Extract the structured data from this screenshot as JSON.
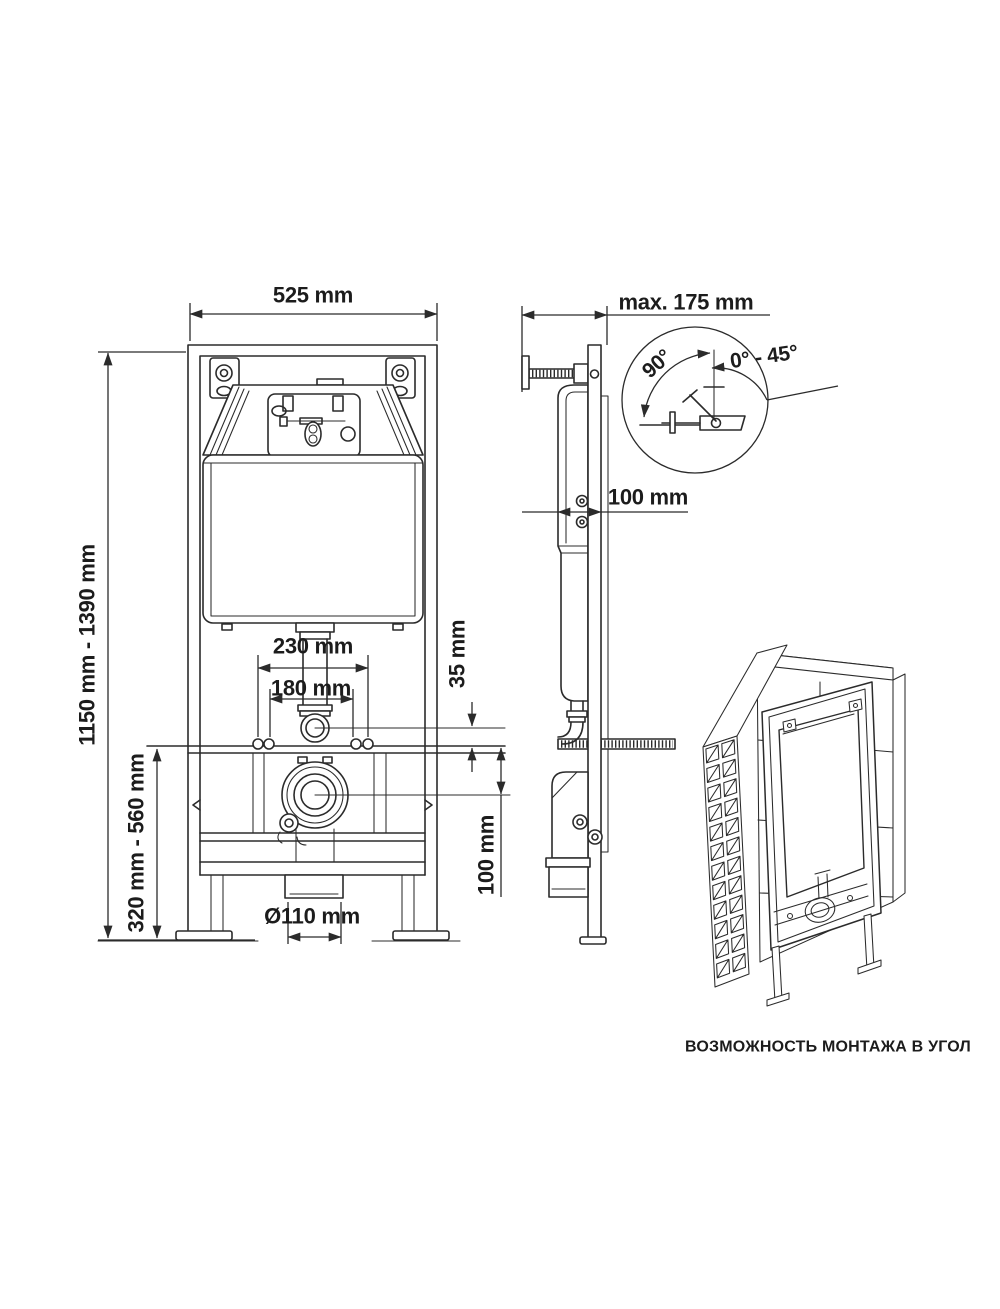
{
  "diagram": {
    "caption": "ВОЗМОЖНОСТЬ МОНТАЖА В УГОЛ",
    "front_view": {
      "frame_width": "525 mm",
      "frame_height_range": "1150 mm - 1390 mm",
      "lower_height_range": "320 mm - 560 mm",
      "bolt_spacing_outer": "230 mm",
      "bolt_spacing_inner": "180 mm",
      "flush_pipe_offset": "35 mm",
      "drain_offset": "100 mm",
      "drain_diameter": "Ø110 mm"
    },
    "side_view": {
      "depth_max": "max. 175 mm",
      "wall_distance": "100 mm",
      "anchor_angle": "90°",
      "anchor_angle_range": "0° - 45°"
    }
  },
  "colors": {
    "line": "#2b2b2b",
    "text": "#1c1c1c",
    "background": "#ffffff"
  }
}
